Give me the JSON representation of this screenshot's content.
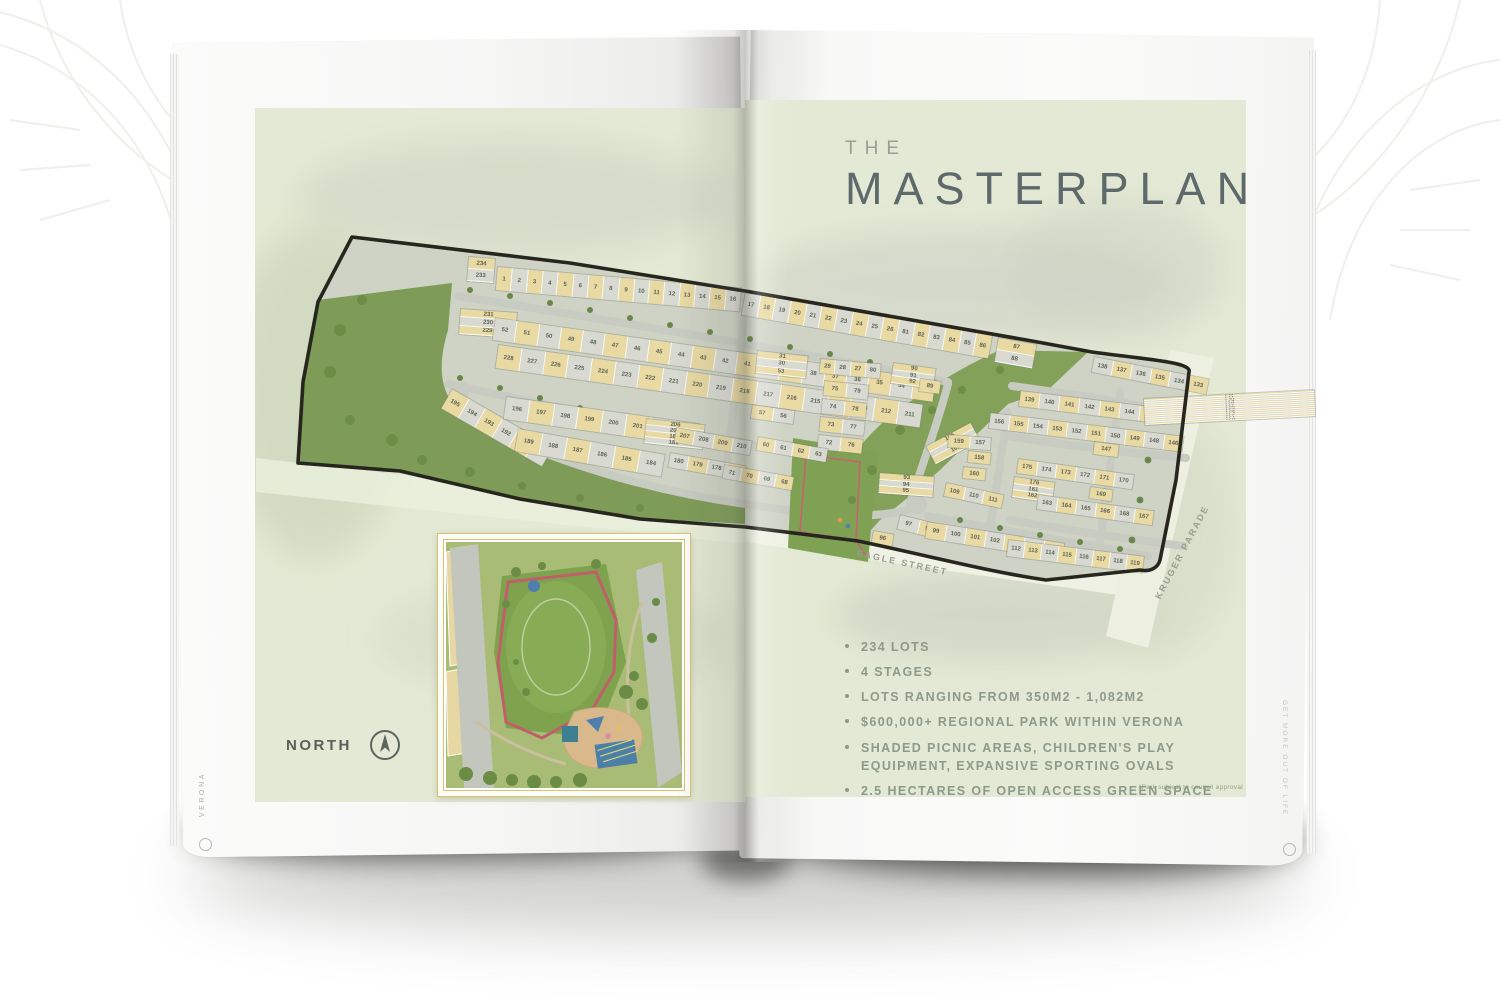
{
  "page": {
    "spine_left": "VERONA",
    "spine_right": "GET MORE OUT OF LIFE",
    "title": {
      "pre": "THE",
      "main": "MASTERPLAN"
    },
    "north_label": "NORTH",
    "disclaimer": "*Park subject to council approval",
    "bullets": [
      "234 LOTS",
      "4 STAGES",
      "LOTS RANGING FROM 350M2 - 1,082M2",
      "$600,000+ REGIONAL PARK WITHIN VERONA",
      "SHADED PICNIC AREAS, CHILDREN'S PLAY EQUIPMENT, EXPANSIVE SPORTING OVALS",
      "2.5 HECTARES OF OPEN ACCESS GREEN SPACE"
    ]
  },
  "map": {
    "street_labels": {
      "eagle": "EAGLE STREET",
      "kruger": "KRUGER PARADE"
    },
    "colors": {
      "lot_yellow": "#e9d9a2",
      "lot_grey": "#d8dad2",
      "park_green": "#7e9c57",
      "road_grey": "#c7cbc1",
      "boundary": "#26261f",
      "page_green": "#e3e9d4",
      "accent_gold": "#ddc269",
      "title_slate": "#5d696b",
      "text_green_grey": "#8d998b"
    },
    "strips": [
      {
        "x": 468,
        "y": 256,
        "w": 26,
        "h": 28,
        "a": 4,
        "v": true,
        "nums": [
          "234",
          "233"
        ]
      },
      {
        "x": 497,
        "y": 266,
        "w": 246,
        "h": 25,
        "a": 5,
        "nums": [
          "1",
          "2",
          "3",
          "4",
          "5",
          "6",
          "7",
          "8",
          "9",
          "10",
          "11",
          "12",
          "13",
          "14",
          "15",
          "16"
        ]
      },
      {
        "x": 745,
        "y": 291,
        "w": 252,
        "h": 25,
        "a": 10,
        "off": 1,
        "nums": [
          "17",
          "18",
          "19",
          "20",
          "21",
          "22",
          "23",
          "24",
          "25",
          "26",
          "81",
          "82",
          "83",
          "84",
          "85",
          "86"
        ]
      },
      {
        "x": 998,
        "y": 337,
        "w": 26,
        "h": 40,
        "a": 10,
        "v": true,
        "nums": [
          "87",
          "88"
        ]
      },
      {
        "x": 460,
        "y": 308,
        "w": 27,
        "h": 58,
        "a": 4,
        "v": true,
        "nums": [
          "231",
          "230",
          "229"
        ]
      },
      {
        "x": 495,
        "y": 317,
        "w": 446,
        "h": 24,
        "a": 8,
        "off": 1,
        "nums": [
          "52",
          "51",
          "50",
          "49",
          "48",
          "47",
          "46",
          "45",
          "44",
          "43",
          "42",
          "41",
          "40",
          "39",
          "38",
          "37",
          "36",
          "35",
          "34",
          "33"
        ]
      },
      {
        "x": 498,
        "y": 344,
        "w": 430,
        "h": 25,
        "a": 8,
        "nums": [
          "228",
          "227",
          "226",
          "225",
          "224",
          "223",
          "222",
          "221",
          "220",
          "219",
          "218",
          "217",
          "216",
          "215",
          "214",
          "213",
          "212",
          "211"
        ]
      },
      {
        "x": 452,
        "y": 388,
        "w": 118,
        "h": 24,
        "a": 30,
        "nums": [
          "195",
          "194",
          "193",
          "192",
          "191",
          "190"
        ]
      },
      {
        "x": 506,
        "y": 396,
        "w": 196,
        "h": 24,
        "a": 8,
        "off": 1,
        "nums": [
          "196",
          "197",
          "198",
          "199",
          "200",
          "201",
          "202",
          "203"
        ]
      },
      {
        "x": 676,
        "y": 424,
        "w": 26,
        "h": 16,
        "a": 8,
        "nums": [
          "204"
        ]
      },
      {
        "x": 518,
        "y": 428,
        "w": 150,
        "h": 24,
        "a": 10,
        "nums": [
          "189",
          "188",
          "187",
          "186",
          "185",
          "184"
        ]
      },
      {
        "x": 757,
        "y": 350,
        "w": 24,
        "h": 52,
        "a": 6,
        "v": true,
        "nums": [
          "31",
          "30",
          "53"
        ]
      },
      {
        "x": 752,
        "y": 404,
        "w": 44,
        "h": 15,
        "a": 8,
        "nums": [
          "57",
          "56"
        ]
      },
      {
        "x": 820,
        "y": 358,
        "w": 62,
        "h": 16,
        "a": 5,
        "nums": [
          "29",
          "28",
          "27",
          "80"
        ]
      },
      {
        "x": 824,
        "y": 380,
        "w": 46,
        "h": 16,
        "a": 6,
        "nums": [
          "75",
          "79"
        ]
      },
      {
        "x": 822,
        "y": 398,
        "w": 46,
        "h": 16,
        "a": 6,
        "off": 1,
        "nums": [
          "74",
          "78"
        ]
      },
      {
        "x": 820,
        "y": 416,
        "w": 46,
        "h": 16,
        "a": 6,
        "nums": [
          "73",
          "77"
        ]
      },
      {
        "x": 818,
        "y": 434,
        "w": 46,
        "h": 16,
        "a": 6,
        "off": 1,
        "nums": [
          "72",
          "76"
        ]
      },
      {
        "x": 646,
        "y": 418,
        "w": 26,
        "h": 60,
        "a": 6,
        "v": true,
        "nums": [
          "206",
          "205",
          "182",
          "181"
        ]
      },
      {
        "x": 676,
        "y": 427,
        "w": 78,
        "h": 16,
        "a": 10,
        "nums": [
          "207",
          "208",
          "209",
          "210"
        ]
      },
      {
        "x": 670,
        "y": 452,
        "w": 78,
        "h": 16,
        "a": 10,
        "off": 1,
        "nums": [
          "180",
          "179",
          "178",
          "177"
        ]
      },
      {
        "x": 758,
        "y": 436,
        "w": 72,
        "h": 15,
        "a": 10,
        "nums": [
          "60",
          "61",
          "62",
          "63"
        ]
      },
      {
        "x": 724,
        "y": 464,
        "w": 72,
        "h": 15,
        "a": 10,
        "off": 1,
        "nums": [
          "71",
          "70",
          "69",
          "68"
        ]
      },
      {
        "x": 893,
        "y": 362,
        "w": 22,
        "h": 44,
        "a": 8,
        "v": true,
        "nums": [
          "90",
          "91",
          "92"
        ]
      },
      {
        "x": 920,
        "y": 378,
        "w": 22,
        "h": 14,
        "a": 8,
        "nums": [
          "89"
        ]
      },
      {
        "x": 879,
        "y": 472,
        "w": 22,
        "h": 56,
        "a": 4,
        "v": true,
        "nums": [
          "93",
          "94",
          "95"
        ]
      },
      {
        "x": 873,
        "y": 530,
        "w": 22,
        "h": 14,
        "a": 10,
        "nums": [
          "96"
        ]
      },
      {
        "x": 900,
        "y": 514,
        "w": 42,
        "h": 16,
        "a": 14,
        "off": 1,
        "nums": [
          "97",
          "98"
        ]
      },
      {
        "x": 927,
        "y": 521,
        "w": 140,
        "h": 18,
        "a": 9,
        "nums": [
          "99",
          "100",
          "101",
          "102",
          "103",
          "104",
          "105"
        ]
      },
      {
        "x": 1008,
        "y": 539,
        "w": 138,
        "h": 18,
        "a": 7,
        "off": 1,
        "nums": [
          "112",
          "113",
          "114",
          "115",
          "116",
          "117",
          "118",
          "119"
        ]
      },
      {
        "x": 925,
        "y": 446,
        "w": 22,
        "h": 52,
        "a": -28,
        "v": true,
        "nums": [
          "106",
          "107",
          "108"
        ]
      },
      {
        "x": 946,
        "y": 482,
        "w": 60,
        "h": 15,
        "a": 12,
        "nums": [
          "109",
          "110",
          "111"
        ]
      },
      {
        "x": 948,
        "y": 434,
        "w": 44,
        "h": 14,
        "a": 4,
        "nums": [
          "159",
          "157"
        ]
      },
      {
        "x": 968,
        "y": 450,
        "w": 24,
        "h": 13,
        "a": 6,
        "nums": [
          "158"
        ]
      },
      {
        "x": 963,
        "y": 466,
        "w": 24,
        "h": 13,
        "a": 6,
        "nums": [
          "160"
        ]
      },
      {
        "x": 1020,
        "y": 390,
        "w": 142,
        "h": 17,
        "a": 7,
        "nums": [
          "139",
          "140",
          "141",
          "142",
          "143",
          "144",
          "145"
        ]
      },
      {
        "x": 990,
        "y": 412,
        "w": 196,
        "h": 17,
        "a": 7,
        "off": 1,
        "nums": [
          "156",
          "155",
          "154",
          "153",
          "152",
          "151",
          "150",
          "149",
          "148",
          "146"
        ]
      },
      {
        "x": 1094,
        "y": 441,
        "w": 26,
        "h": 14,
        "a": 7,
        "nums": [
          "147"
        ]
      },
      {
        "x": 1094,
        "y": 356,
        "w": 118,
        "h": 17,
        "a": 11,
        "off": 1,
        "nums": [
          "138",
          "137",
          "136",
          "135",
          "134",
          "133"
        ]
      },
      {
        "x": 1143,
        "y": 398,
        "w": 28,
        "h": 172,
        "a": -3,
        "v": true,
        "nums": [
          "132",
          "131",
          "130",
          "129",
          "128",
          "127",
          "126",
          "125",
          "124",
          "123",
          "122",
          "121",
          "120"
        ]
      },
      {
        "x": 1018,
        "y": 458,
        "w": 118,
        "h": 16,
        "a": 8,
        "nums": [
          "175",
          "174",
          "173",
          "172",
          "171",
          "170"
        ]
      },
      {
        "x": 1014,
        "y": 476,
        "w": 22,
        "h": 42,
        "a": 8,
        "v": true,
        "nums": [
          "176",
          "161",
          "162"
        ]
      },
      {
        "x": 1038,
        "y": 494,
        "w": 118,
        "h": 16,
        "a": 8,
        "off": 1,
        "nums": [
          "163",
          "164",
          "165",
          "166",
          "168",
          "167"
        ]
      },
      {
        "x": 1090,
        "y": 486,
        "w": 24,
        "h": 13,
        "a": 8,
        "nums": [
          "169"
        ]
      }
    ]
  }
}
